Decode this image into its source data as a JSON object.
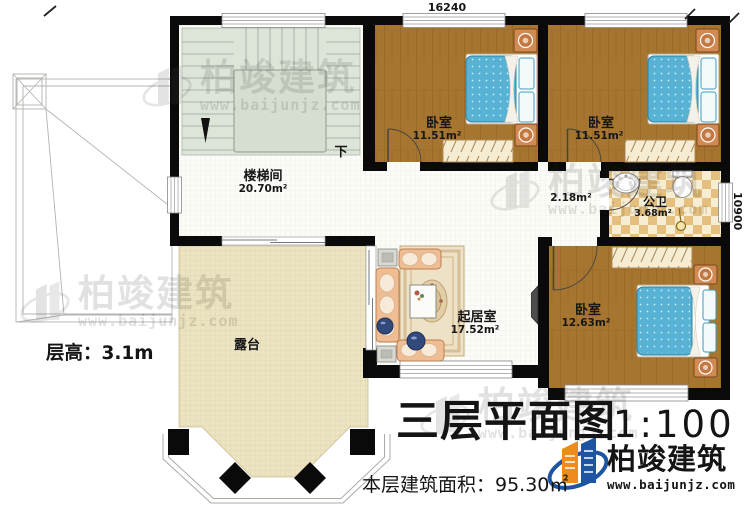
{
  "titleblock": {
    "title": "三层平面图",
    "scale": "1:100",
    "area_line": "本层建筑面积：95.30㎡",
    "floor_height": "层高：3.1m"
  },
  "dims": {
    "top_width": "16240",
    "right_height": "10900"
  },
  "rooms": {
    "stairwell": {
      "name": "楼梯间",
      "area": "20.70m²",
      "direction": "下"
    },
    "bedroom_a": {
      "name": "卧室",
      "area": "11.51m²"
    },
    "bedroom_b": {
      "name": "卧室",
      "area": "11.51m²"
    },
    "bedroom_c": {
      "name": "卧室",
      "area": "12.63m²"
    },
    "hallway": {
      "area": "2.18m²"
    },
    "bathroom": {
      "name": "公卫",
      "area": "3.68m²"
    },
    "living": {
      "name": "起居室",
      "area": "17.52m²"
    },
    "terrace": {
      "name": "露台"
    }
  },
  "branding": {
    "company": "柏竣建筑",
    "website": "www.baijunjz.com"
  },
  "watermark": {
    "company": "柏竣建筑",
    "website": "www.baijunjz.com"
  },
  "colors": {
    "wall": "#0a0a0a",
    "wood_floor": "#a6752f",
    "bed_mattress": "#57b2d3",
    "terrace_floor": "#ebe3c1",
    "bathroom_tile": "#e5bf7e",
    "stair_floor": "#dde4d8",
    "sofa": "#eebd93",
    "brand_orange": "#ef8b1d",
    "brand_blue": "#1d55a3"
  }
}
